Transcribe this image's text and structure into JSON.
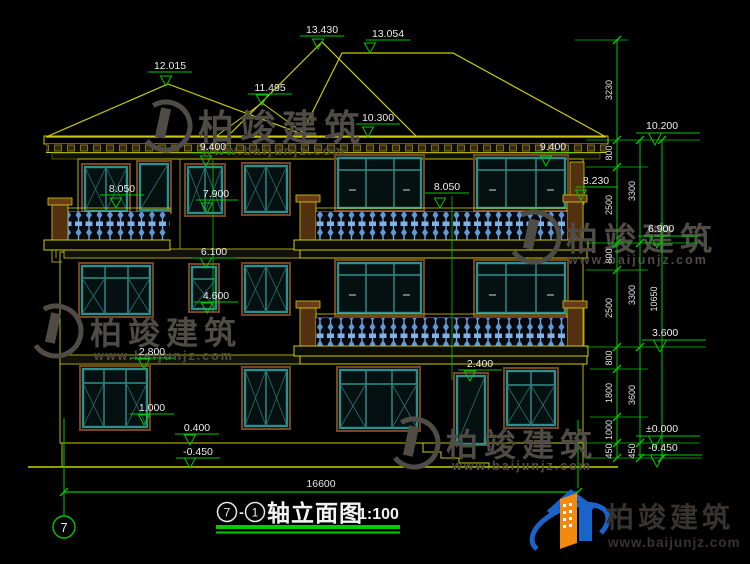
{
  "elev": [
    "13.430",
    "13.054",
    "12.015",
    "11.495",
    "10.300",
    "9.400",
    "9.400",
    "8.050",
    "8.050",
    "8.230",
    "7.900",
    "6.100",
    "4.600",
    "2.800",
    "1.000",
    "0.400",
    "-0.450",
    "2.400"
  ],
  "elev_right": [
    "10.200",
    "6.900",
    "3.600",
    "±0.000",
    "-0.450"
  ],
  "dims_inner": [
    "3230",
    "800",
    "2500",
    "800",
    "2500",
    "800",
    "1800",
    "1000",
    "450"
  ],
  "dims_mid": [
    "3300",
    "3300",
    "3600",
    "450"
  ],
  "dims_outer": [
    "10650"
  ],
  "bottom_dim": "16600",
  "axis_bubble": "7",
  "title": {
    "axis_start": "7",
    "separator": "-",
    "axis_end": "1",
    "name": "轴立面图",
    "scale": "1:100"
  },
  "brand": {
    "name": "柏竣建筑",
    "url": "www.baijunjz.com"
  },
  "colors": {
    "cad_yellow": "#cccc00",
    "cad_green": "#00c800",
    "window_teal": "#2f8f8c",
    "baluster_blue": "#7fb2e8",
    "logo_blue": "#1a63c8",
    "logo_orange": "#f28a0f"
  }
}
